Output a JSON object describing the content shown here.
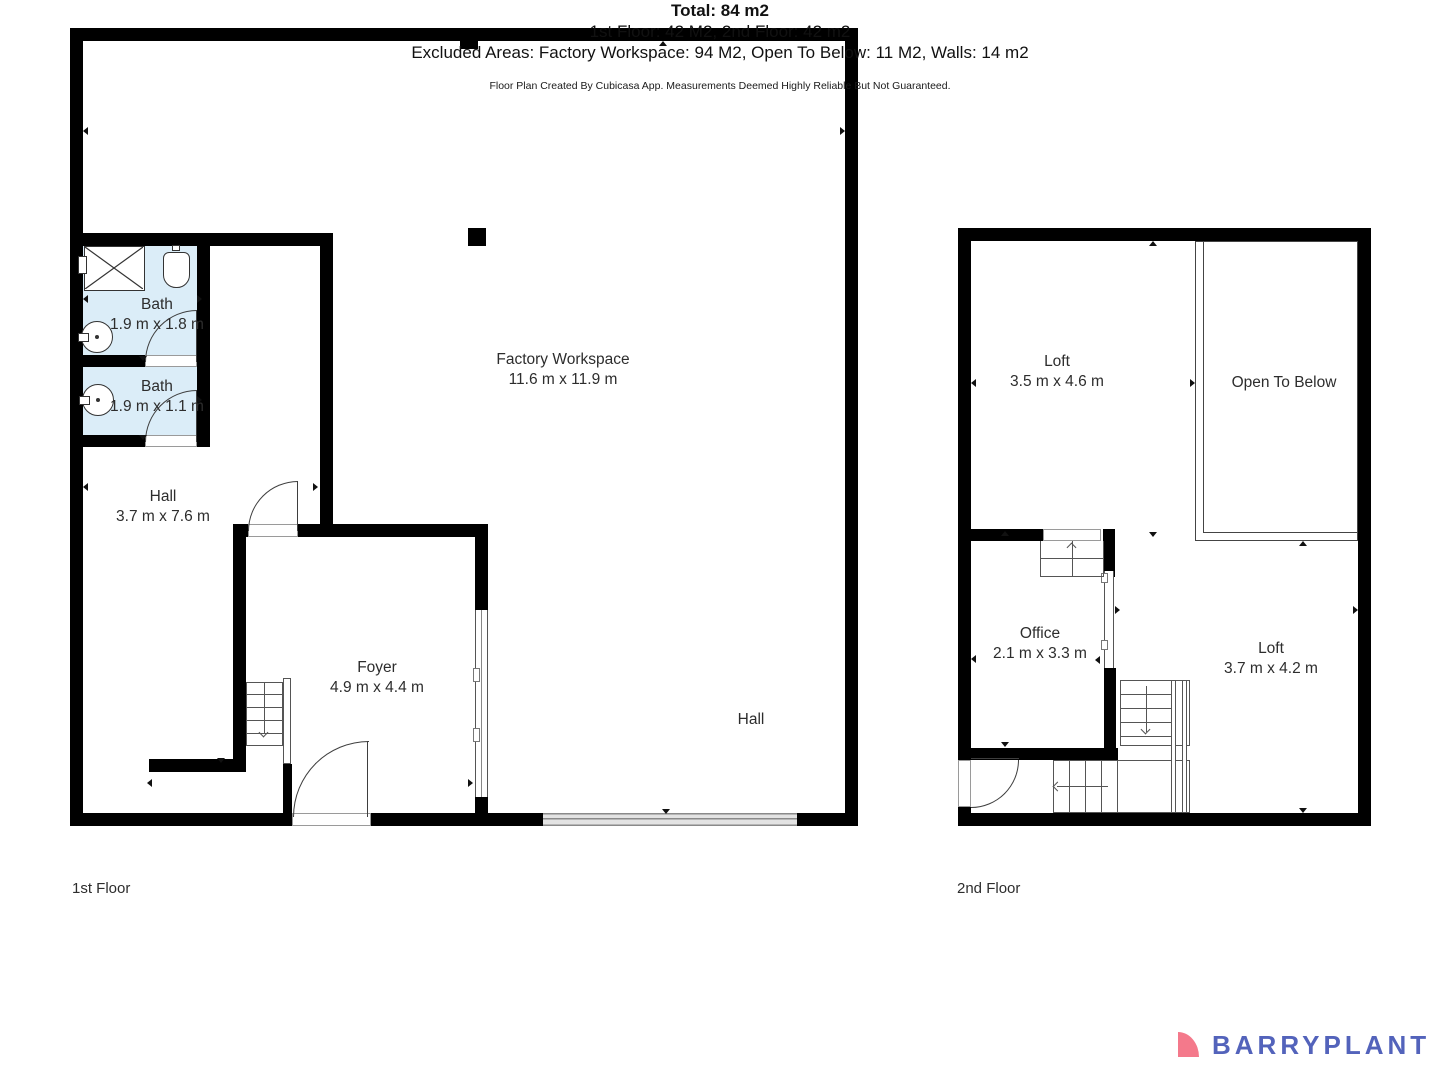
{
  "floor1": {
    "label": "1st Floor",
    "rooms": {
      "factory": {
        "name": "Factory Workspace",
        "dims": "11.6 m x 11.9 m"
      },
      "bath1": {
        "name": "Bath",
        "dims": "1.9 m x 1.8 m"
      },
      "bath2": {
        "name": "Bath",
        "dims": "1.9 m x 1.1 m"
      },
      "hall": {
        "name": "Hall",
        "dims": "3.7 m x 7.6 m"
      },
      "foyer": {
        "name": "Foyer",
        "dims": "4.9 m x 4.4 m"
      },
      "hall_right": {
        "name": "Hall"
      }
    }
  },
  "floor2": {
    "label": "2nd Floor",
    "rooms": {
      "loft_top": {
        "name": "Loft",
        "dims": "3.5 m x 4.6 m"
      },
      "open_below": {
        "name": "Open To Below"
      },
      "office": {
        "name": "Office",
        "dims": "2.1 m x 3.3 m"
      },
      "loft_bottom": {
        "name": "Loft",
        "dims": "3.7 m x 4.2 m"
      }
    }
  },
  "summary": {
    "total": "Total: 84 m2",
    "floors": "1st Floor: 42 M2, 2nd Floor: 42 m2",
    "excluded": "Excluded Areas: Factory Workspace: 94 M2, Open To Below: 11 M2, Walls: 14 m2",
    "disclaimer": "Floor Plan Created By Cubicasa App. Measurements Deemed Highly Reliable But Not Guaranteed."
  },
  "branding": {
    "logo_text": "BARRYPLANT"
  },
  "colors": {
    "wall": "#000000",
    "bath_fill": "#DBEDF8",
    "plan_line": "#555555",
    "sliding_door": "#8A8A8A",
    "logo_pink": "#F4798B",
    "logo_blue": "#5363BB"
  }
}
